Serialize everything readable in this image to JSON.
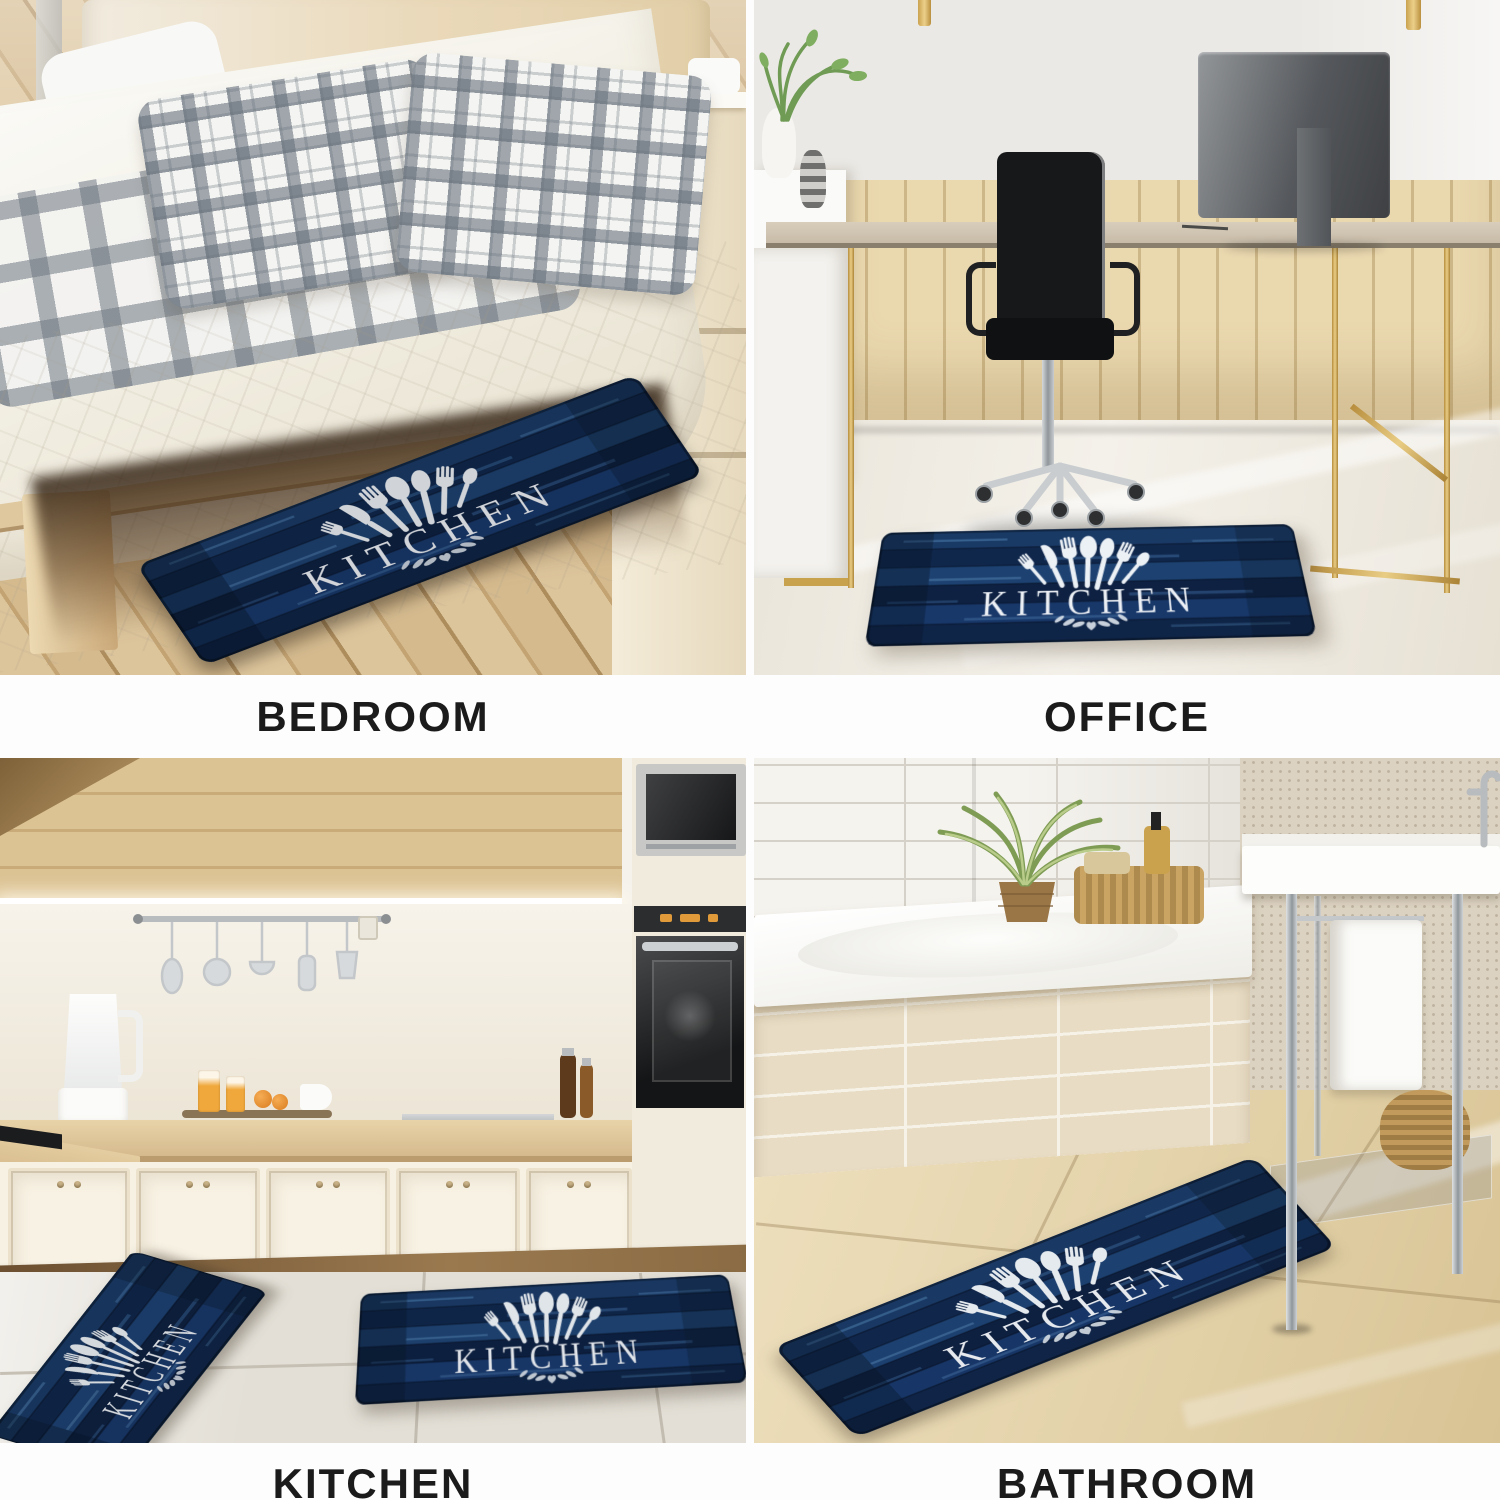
{
  "collage": {
    "type": "product-scene-grid",
    "rows": 2,
    "cols": 2,
    "captions": {
      "bedroom": "BEDROOM",
      "office": "OFFICE",
      "kitchen": "KITCHEN",
      "bathroom": "BATHROOM"
    },
    "caption_color": "#1b1b1b",
    "background": "#fdfdfd"
  },
  "mat": {
    "text": "KITCHEN",
    "description": "navy wood-plank kitchen mat with white cutlery print",
    "colors": {
      "navy_dark": "#0d2043",
      "navy_mid": "#16335f",
      "navy_light": "#3f6fa3",
      "print_white": "#edf1f6"
    },
    "icons": [
      "fork-icon",
      "knife-icon",
      "spoon-icon",
      "ladle-icon",
      "laurel-flourish-icon"
    ]
  }
}
